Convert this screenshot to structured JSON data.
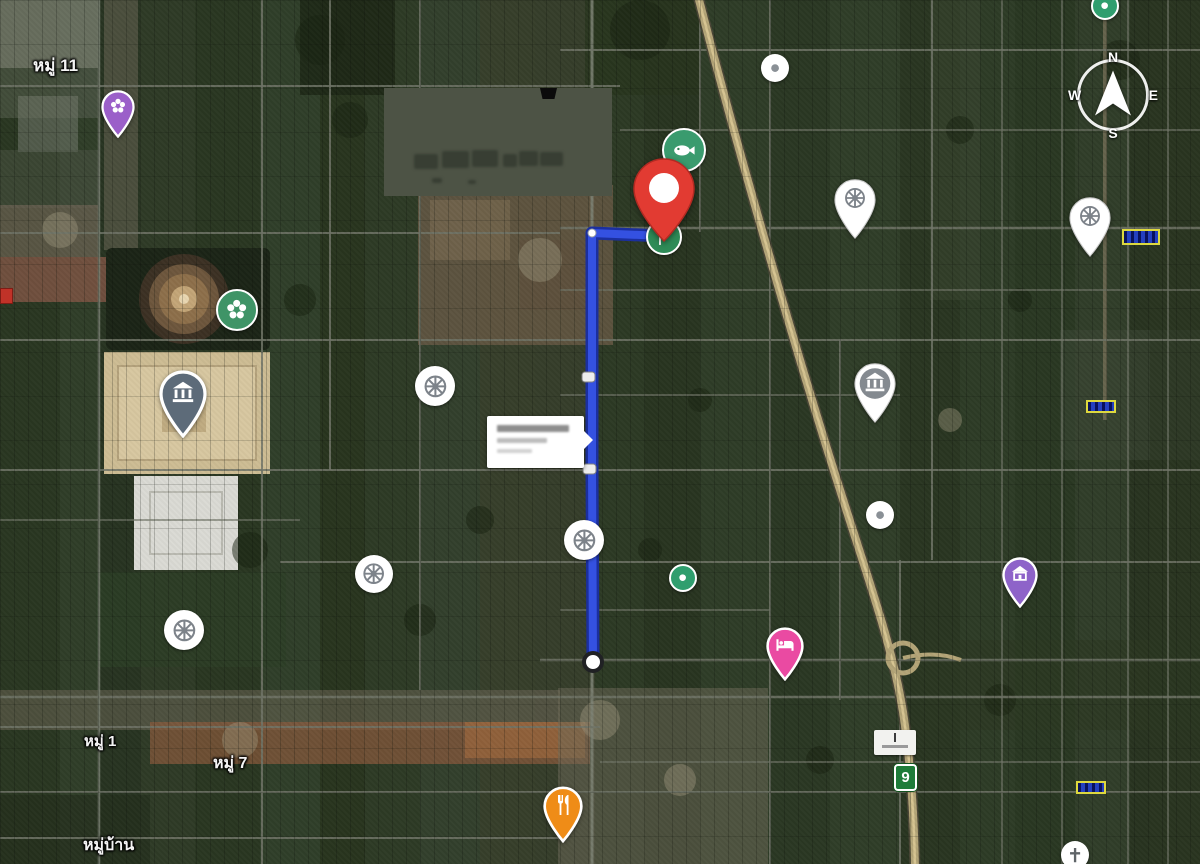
{
  "map": {
    "kind": "satellite-route-map",
    "compass": {
      "north": "N",
      "east": "E",
      "south": "S",
      "west": "W"
    },
    "area_labels": [
      {
        "text": "หมู่ 11",
        "x": 33,
        "y": 52,
        "size": 17
      },
      {
        "text": "หมู่ 1",
        "x": 84,
        "y": 729,
        "size": 15
      },
      {
        "text": "หมู่ 7",
        "x": 213,
        "y": 751,
        "size": 16
      },
      {
        "text": "หมู่บ้าน",
        "x": 83,
        "y": 833,
        "size": 16
      }
    ],
    "route": {
      "color": "#3451e1",
      "casing": "#1b2f9e",
      "points": "664,236 592,233 592,470 593,662",
      "corner_dot": {
        "x": 592,
        "y": 233
      },
      "mid_markers": [
        {
          "x": 582,
          "y": 372
        },
        {
          "x": 583,
          "y": 464
        }
      ],
      "end_circle": {
        "x": 593,
        "y": 662
      }
    },
    "destination_pin": {
      "color": "#e23b32",
      "tip_x": 664,
      "tip_y": 243
    },
    "start_flag": {
      "color": "#2e8b57",
      "icon": "flag-icon",
      "x": 664,
      "y": 237
    },
    "pois": [
      {
        "name": "government-office-pin",
        "kind": "pin",
        "color": "#9b5fc9",
        "icon": "flower",
        "iconColor": "#ffffff",
        "x": 118,
        "y": 138,
        "w": 34
      },
      {
        "name": "park-poi",
        "kind": "circle",
        "color": "#3f9467",
        "icon": "flower",
        "iconColor": "#ffffff",
        "x": 237,
        "y": 310,
        "w": 42,
        "ring": true
      },
      {
        "name": "temple-landmark-pin",
        "kind": "pin",
        "color": "#5d6b79",
        "icon": "bank",
        "iconColor": "#ffffff",
        "x": 183,
        "y": 438,
        "w": 48
      },
      {
        "name": "buddhist-temple-poi",
        "kind": "circle",
        "color": "#ffffff",
        "icon": "wheel",
        "iconColor": "#7d838a",
        "x": 435,
        "y": 386,
        "w": 40
      },
      {
        "name": "buddhist-temple-poi",
        "kind": "circle",
        "color": "#ffffff",
        "icon": "wheel",
        "iconColor": "#7d838a",
        "x": 374,
        "y": 574,
        "w": 38
      },
      {
        "name": "buddhist-temple-poi",
        "kind": "circle",
        "color": "#ffffff",
        "icon": "wheel",
        "iconColor": "#7d838a",
        "x": 584,
        "y": 540,
        "w": 40
      },
      {
        "name": "buddhist-temple-poi",
        "kind": "circle",
        "color": "#ffffff",
        "icon": "wheel",
        "iconColor": "#7d838a",
        "x": 184,
        "y": 630,
        "w": 40
      },
      {
        "name": "buddhist-temple-pin",
        "kind": "pin",
        "color": "#ffffff",
        "icon": "wheel",
        "iconColor": "#7d838a",
        "x": 855,
        "y": 240,
        "w": 44
      },
      {
        "name": "buddhist-temple-pin",
        "kind": "pin",
        "color": "#ffffff",
        "icon": "wheel",
        "iconColor": "#7d838a",
        "x": 1090,
        "y": 258,
        "w": 44
      },
      {
        "name": "gray-dot-poi",
        "kind": "circle",
        "color": "#ffffff",
        "icon": "dot",
        "iconColor": "#8a9096",
        "x": 775,
        "y": 68,
        "w": 28
      },
      {
        "name": "gray-dot-poi",
        "kind": "circle",
        "color": "#ffffff",
        "icon": "dot",
        "iconColor": "#8a9096",
        "x": 880,
        "y": 515,
        "w": 28
      },
      {
        "name": "green-dot-poi",
        "kind": "circle",
        "color": "#2f9e6e",
        "icon": "dot",
        "iconColor": "#ffffff",
        "x": 683,
        "y": 578,
        "w": 28,
        "ring": true
      },
      {
        "name": "seafood-restaurant-poi",
        "kind": "circle",
        "color": "#3a9b6e",
        "icon": "fish",
        "iconColor": "#ffffff",
        "x": 684,
        "y": 150,
        "w": 44,
        "ring": true
      },
      {
        "name": "bank-pin",
        "kind": "pin",
        "color": "#ffffff",
        "icon": "bank",
        "iconColor": "#ffffff",
        "inner": "#848a90",
        "x": 875,
        "y": 424,
        "w": 44
      },
      {
        "name": "museum-pin",
        "kind": "pin",
        "color": "#8e63c9",
        "icon": "museum",
        "iconColor": "#ffffff",
        "x": 1020,
        "y": 608,
        "w": 36
      },
      {
        "name": "hotel-pin",
        "kind": "pin",
        "color": "#ea4aa2",
        "icon": "bed",
        "iconColor": "#ffffff",
        "x": 785,
        "y": 681,
        "w": 38
      },
      {
        "name": "restaurant-pin",
        "kind": "pin",
        "color": "#ef8c17",
        "icon": "fork",
        "iconColor": "#ffffff",
        "x": 563,
        "y": 843,
        "w": 40
      },
      {
        "name": "church-poi",
        "kind": "circle",
        "color": "#ffffff",
        "icon": "cross",
        "iconColor": "#5f6468",
        "x": 1075,
        "y": 855,
        "w": 28
      },
      {
        "name": "green-dot-poi",
        "kind": "circle",
        "color": "#2f9e6e",
        "icon": "dot",
        "iconColor": "#ffffff",
        "x": 1105,
        "y": 6,
        "w": 28,
        "ring": true
      }
    ],
    "signs": [
      {
        "kind": "plate",
        "name": "blue-yellow-sign",
        "x": 1122,
        "y": 229,
        "w": 38,
        "h": 16
      },
      {
        "kind": "plate",
        "name": "blue-yellow-sign",
        "x": 1086,
        "y": 400,
        "w": 30,
        "h": 13
      },
      {
        "kind": "plate",
        "name": "blue-yellow-sign",
        "x": 1076,
        "y": 781,
        "w": 30,
        "h": 13
      },
      {
        "kind": "whitesign",
        "name": "road-sign-white",
        "x": 874,
        "y": 730,
        "w": 42,
        "h": 25
      },
      {
        "kind": "shield",
        "name": "highway-9-shield",
        "x": 894,
        "y": 764,
        "w": 23,
        "h": 27,
        "text": "9"
      },
      {
        "kind": "redbox",
        "name": "red-edge-marker",
        "x": 0,
        "y": 288,
        "w": 13,
        "h": 16
      }
    ],
    "colors": {
      "route_blue": "#3451e1",
      "pin_red": "#e23b32",
      "flag_green": "#2e8b57",
      "poi_green": "#3a9b6e",
      "poi_purple": "#9b5fc9",
      "poi_pink": "#ea4aa2",
      "poi_orange": "#ef8c17",
      "shield_green": "#1e7c39"
    }
  }
}
